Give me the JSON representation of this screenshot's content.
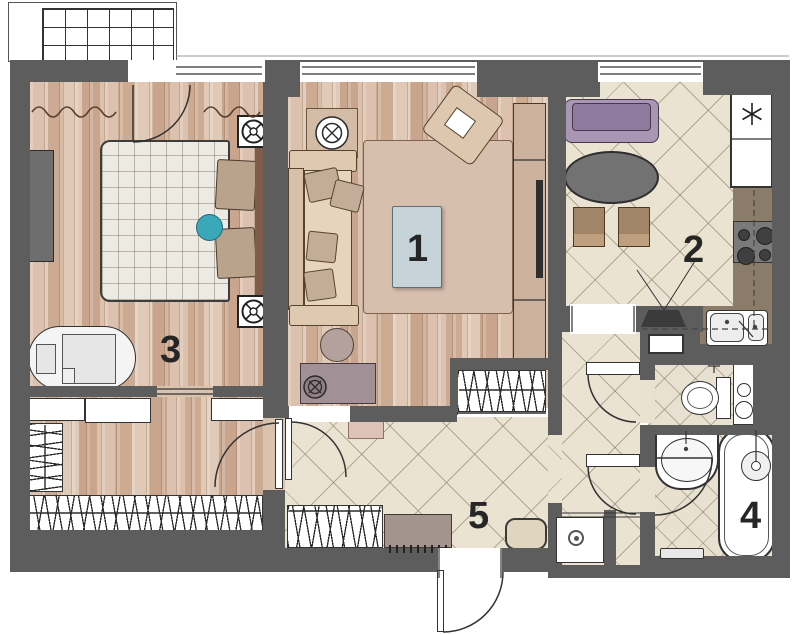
{
  "title": "Two-room apartment floor plan",
  "rooms": [
    {
      "number": "1",
      "name": "living-room"
    },
    {
      "number": "2",
      "name": "kitchen"
    },
    {
      "number": "3",
      "name": "bedroom"
    },
    {
      "number": "4",
      "name": "bathroom"
    },
    {
      "number": "5",
      "name": "hallway"
    }
  ],
  "fixtures": [
    "balcony-glazing",
    "bed",
    "crib",
    "dresser-tv",
    "ceiling-light",
    "wardrobe-shelves",
    "hanging-rail",
    "sofa",
    "armchair",
    "rug",
    "coffee-table",
    "desk",
    "desk-chair",
    "tv-unit",
    "dining-sofa",
    "dining-table",
    "dining-chair",
    "fridge",
    "stove",
    "kitchen-sink",
    "wall-tv",
    "toilet",
    "bathroom-sink",
    "bathtub",
    "shower-head",
    "bench",
    "washing-machine",
    "pouf",
    "shoe-cabinet",
    "doormat",
    "entry-door"
  ],
  "colors": {
    "wall": "#5d5d5d",
    "wood_floor": "#d5b9a4",
    "tile_floor": "#eae3d2",
    "accent_teal": "#3ba8ba",
    "accent_purple": "#a996b4",
    "coffee_table_blue": "#c6d4d9",
    "counter_brown": "#8b7b69",
    "label_color": "#262626"
  }
}
